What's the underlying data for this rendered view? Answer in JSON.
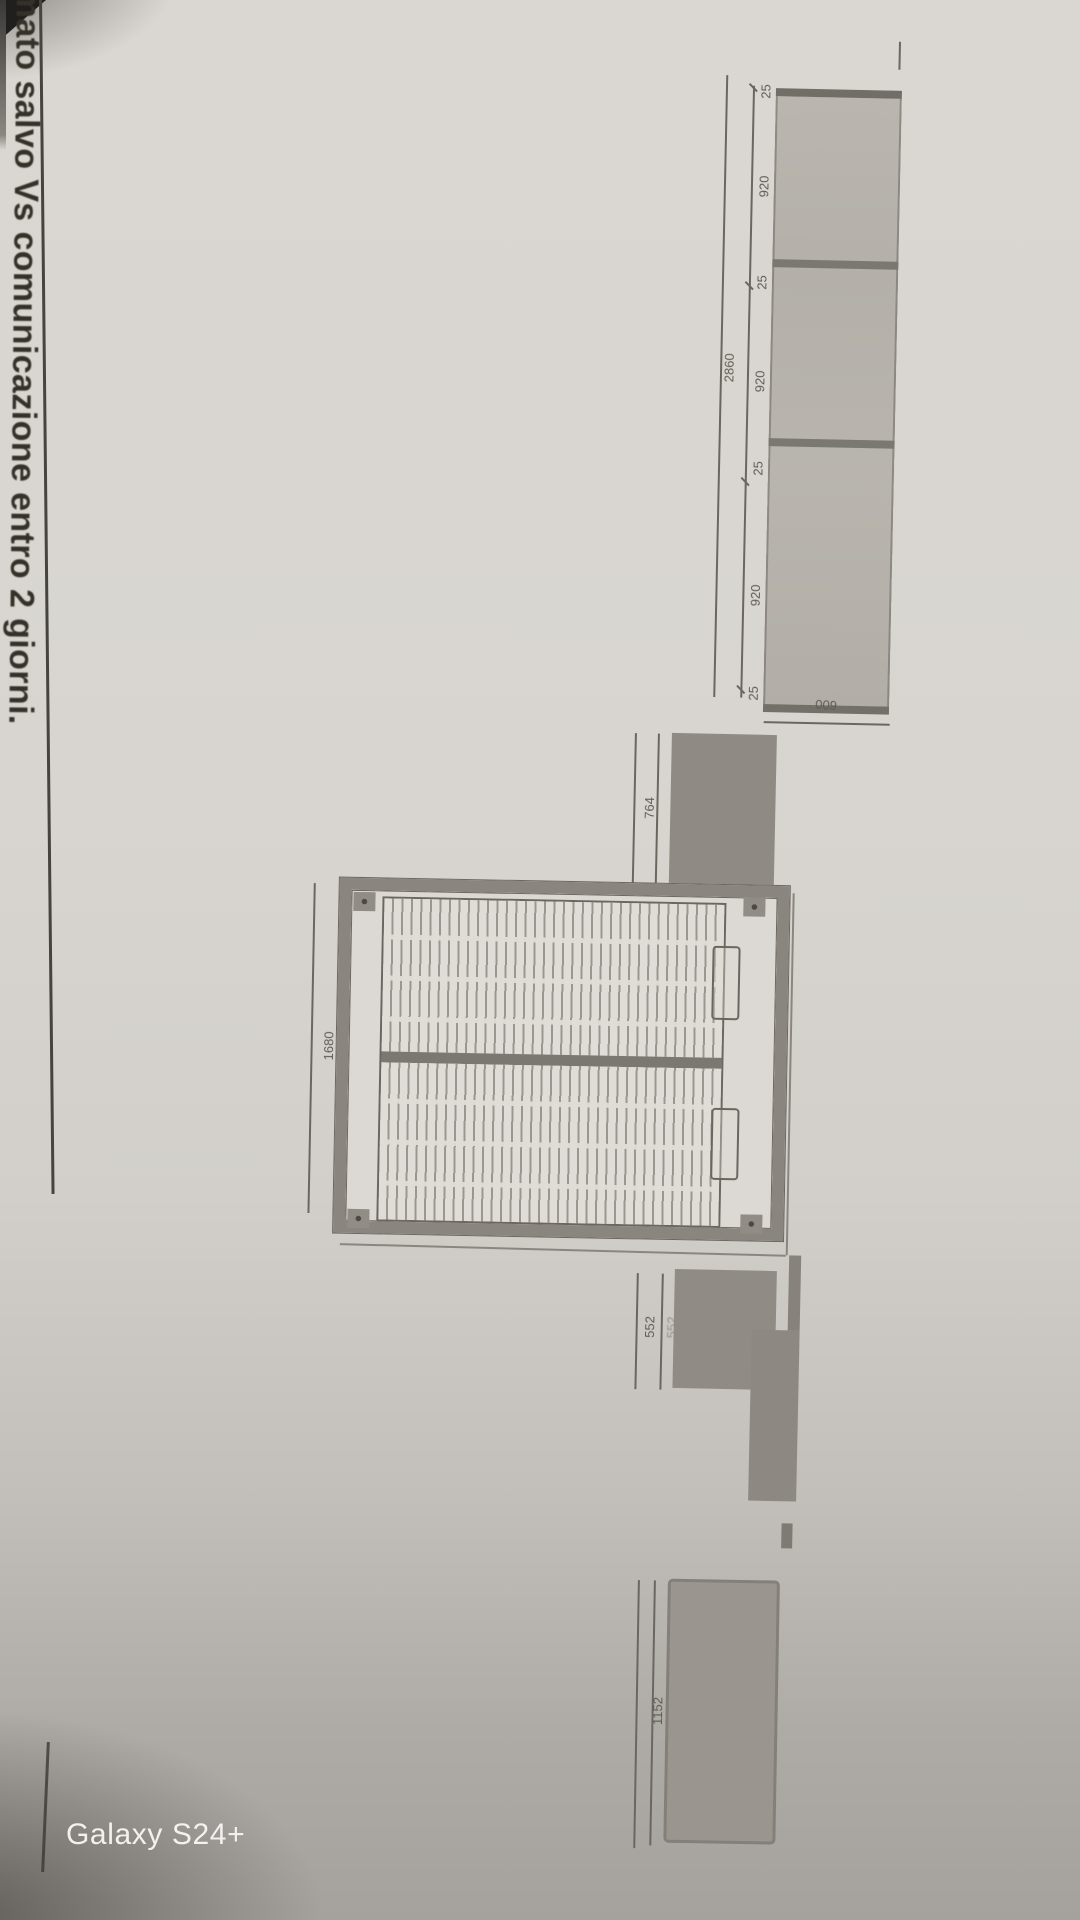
{
  "note": {
    "text": "mato salvo Vs comunicazione entro 2 giorni."
  },
  "watermark": {
    "label": "Galaxy S24+"
  },
  "colors": {
    "paper": "#d8d5d0",
    "ink": "#343129",
    "dim_text": "#5f5b55",
    "panel_fill": "#b7b3ac",
    "dark_element": "#8f8b84",
    "line": "#6b675f"
  },
  "panel_unit": {
    "description": "column of three panels, front view",
    "total_length": "2860",
    "segments": [
      "25",
      "920",
      "25",
      "920",
      "25",
      "920",
      "25"
    ],
    "width": "600"
  },
  "bed_unit": {
    "description": "slatted bed/sofa frame plan with two mattress halves",
    "length": "1680",
    "upper_side_element": "764",
    "lower_side_element": "552"
  },
  "shelf_unit": {
    "length": "1152"
  }
}
